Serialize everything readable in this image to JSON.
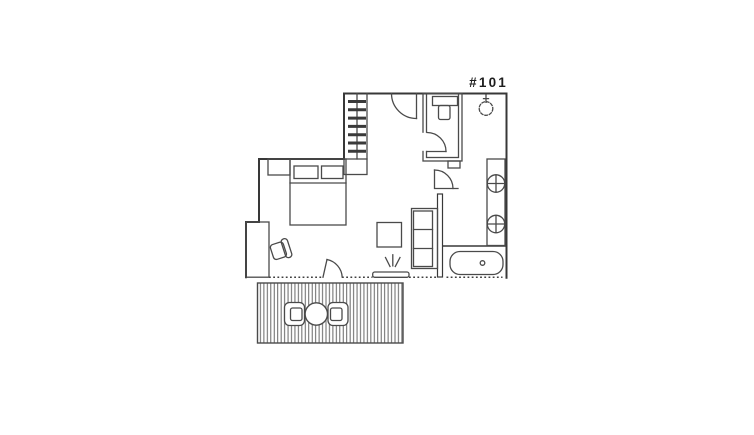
{
  "floorplan": {
    "unit_label": "#101",
    "colors": {
      "background": "#ffffff",
      "wall": "#383838",
      "fixture": "#4a4a4a",
      "label": "#1d1d1d",
      "deck_stripe": "#565656"
    },
    "elements": [
      "loft-ladder",
      "entry-door",
      "wc-room",
      "toilet",
      "wc-door",
      "ceiling-light",
      "kitchen-counter",
      "burner-top",
      "burner-bottom",
      "bed",
      "pillow-left",
      "pillow-right",
      "nightstand",
      "desk",
      "desk-chair",
      "sofa",
      "coffee-table",
      "tv",
      "balcony-door",
      "bath-door",
      "bathtub",
      "drain",
      "deck",
      "deck-table",
      "deck-chair-left",
      "deck-chair-right"
    ]
  }
}
